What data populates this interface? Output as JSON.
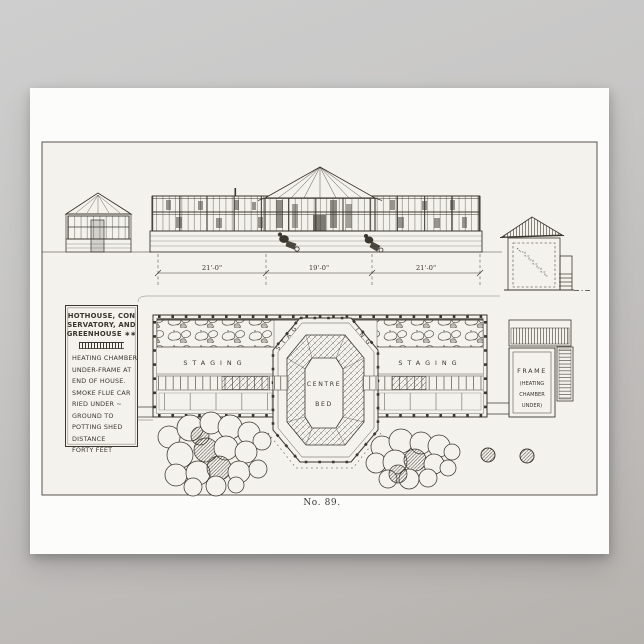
{
  "scene": {
    "background_top": "#cecece",
    "background_bottom": "#b6b2ae"
  },
  "poster": {
    "paper_color": "#fcfcfb",
    "plate_color": "#f4f2ed",
    "ink_color": "#3a372f",
    "caption": "No. 89."
  },
  "title_box": {
    "title_lines": [
      "HOTHOUSE, CON",
      "SERVATORY, AND",
      "GREENHOUSE ∗∗"
    ],
    "note_lines": [
      "HEATING CHAMBER",
      "UNDER-FRAME AT",
      "END OF HOUSE.",
      "SMOKE FLUE CAR",
      "RIED UNDER ~",
      "GROUND TO",
      "POTTING SHED",
      "DISTANCE",
      "FORTY FEET"
    ]
  },
  "elevation": {
    "dim_labels": [
      "21'-0\"",
      "19'-0\"",
      "21'-0\""
    ]
  },
  "plan": {
    "staging_left": "STAGING",
    "staging_right": "STAGING",
    "staging_arc_left": "STAG",
    "staging_arc_right": "ING",
    "centre_line1": "CENTRE",
    "centre_line2": "BED",
    "frame_lines": [
      "FRAME",
      "(HEATING",
      "CHAMBER",
      "UNDER)"
    ]
  }
}
